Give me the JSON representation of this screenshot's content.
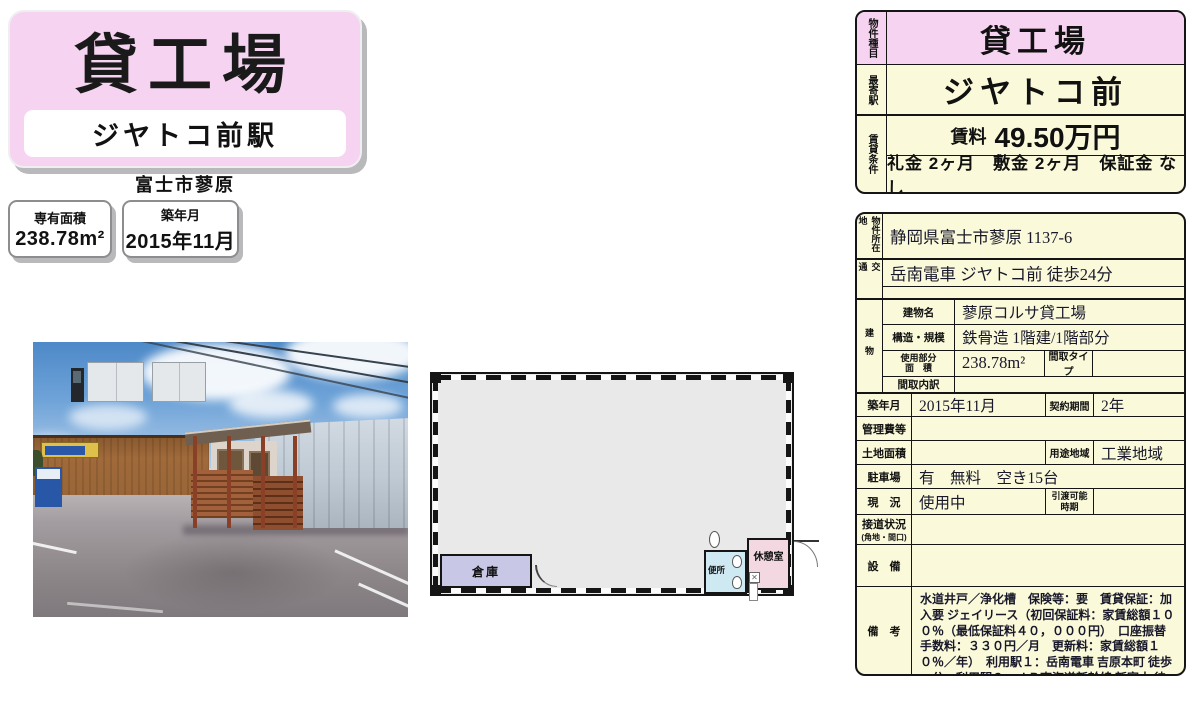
{
  "header": {
    "title": "貸工場",
    "station": "ジヤトコ前駅",
    "area_label": "富士市蓼原",
    "badges": [
      {
        "label": "専有面積",
        "value": "238.78m²"
      },
      {
        "label": "築年月",
        "value": "2015年11月"
      }
    ]
  },
  "summary": {
    "type_label": "物件種目",
    "type_value": "貸工場",
    "station_label": "最寄駅",
    "station_value": "ジヤトコ前",
    "terms_label": "賃貸条件",
    "rent_label": "賃料",
    "rent_value": "49.50万円",
    "fees": "礼金 2ヶ月　敷金 2ヶ月　保証金 なし"
  },
  "details": {
    "address": {
      "label": "物件所在地",
      "value": "静岡県富士市蓼原 1137-6"
    },
    "access": {
      "label": "交通",
      "line1": "岳南電車 ジヤトコ前 徒歩24分",
      "line2": ""
    },
    "building": {
      "label": "建物",
      "name": {
        "label": "建物名",
        "value": "蓼原コルサ貸工場"
      },
      "structure": {
        "label": "構造・規模",
        "value": "鉄骨造 1階建/1階部分"
      },
      "area": {
        "label_line1": "使用部分",
        "label_line2": "面　積",
        "value": "238.78m²",
        "label2": "間取タイプ",
        "value2": ""
      },
      "layout": {
        "label": "間取内訳",
        "value": ""
      }
    },
    "built": {
      "label": "築年月",
      "value": "2015年11月",
      "label2": "契約期間",
      "value2": "2年"
    },
    "mgmt": {
      "label": "管理費等",
      "value": ""
    },
    "land": {
      "label": "土地面積",
      "value": "",
      "label2": "用途地域",
      "value2": "工業地域"
    },
    "parking": {
      "label": "駐車場",
      "value": "有　無料　空き15台"
    },
    "status": {
      "label": "現　況",
      "value": "使用中",
      "label2_line1": "引渡可能",
      "label2_line2": "時期",
      "value2": ""
    },
    "road": {
      "label": "接道状況",
      "sublabel": "(角地・間口)",
      "value": ""
    },
    "equip": {
      "label": "設　備",
      "value": ""
    },
    "remarks": {
      "label": "備　考",
      "value": "水道井戸／浄化槽　保険等：要　賃貸保証：加入要 ジェイリース（初回保証料：家賃総額１００％（最低保証料４０，０００円）　口座振替手数料：３３０円／月　更新料：家賃総額１０％／年）　利用駅１：岳南電車 吉原本町 徒歩26分　利用駅２：ＪＲ東海道新幹線 新富士 徒歩30分"
    }
  },
  "floorplan": {
    "warehouse": "倉庫",
    "toilet": "便所",
    "break_room": "休憩室"
  },
  "colors": {
    "accent_pink": "#f6d4f1",
    "cream": "#faf9da",
    "plan_warehouse": "#c8c8e6",
    "plan_toilet": "#cfe9f2",
    "plan_break_room": "#f3d8e2"
  }
}
